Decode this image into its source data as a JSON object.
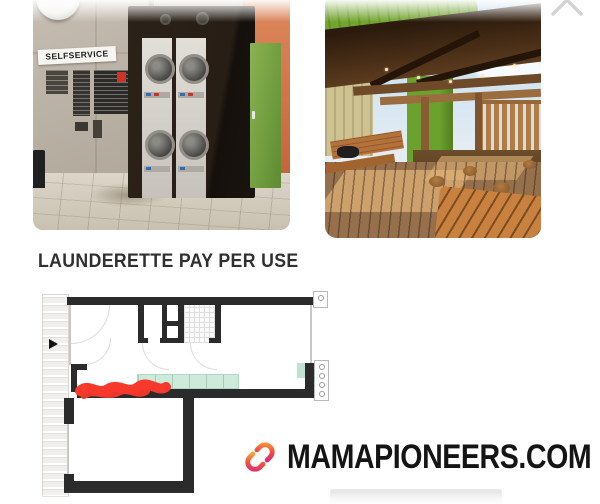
{
  "viewer": {
    "close_icon": "x-close"
  },
  "photos": {
    "left": {
      "description": "launderette interior with stacked washing machines",
      "sign": "SELFSERVICE"
    },
    "right": {
      "description": "rooftop wooden terrace with pergola and picnic table"
    }
  },
  "heading": "LAUNDERETTE PAY PER USE",
  "floorplan": {
    "marker_color": "#f6392b",
    "counter_color": "#cdeadb",
    "wall_color": "#2b2b2b"
  },
  "brand": {
    "text": "MAMAPIONEERS.COM",
    "logo_colors": {
      "orange": "#f9a13b",
      "red": "#f2503c",
      "pink": "#dd2a7b"
    }
  }
}
